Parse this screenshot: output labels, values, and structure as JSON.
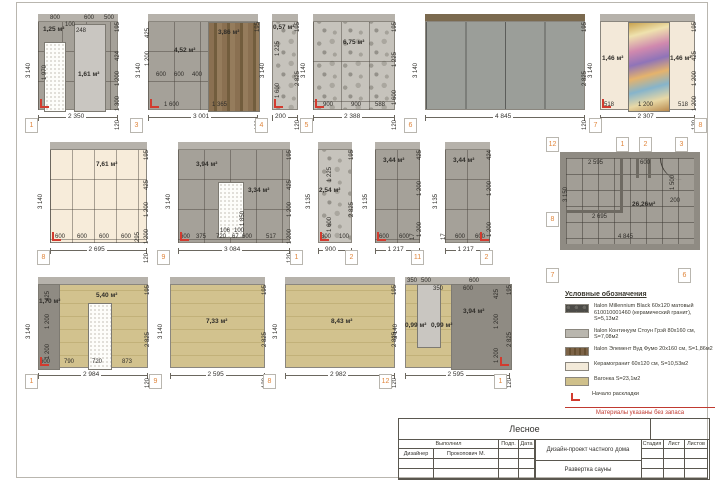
{
  "sheet": {
    "title_object": "Лесное"
  },
  "elevations": [
    {
      "id": "1",
      "x": 38,
      "y": 14,
      "w": 80,
      "h": 96,
      "fill": "gray",
      "band": "gray",
      "grid": [
        24,
        30
      ],
      "features": [
        {
          "t": "lightpanel",
          "x": 36,
          "y": 10,
          "w": 30,
          "h": 86
        },
        {
          "t": "door",
          "x": 6,
          "y": 28,
          "w": 20,
          "h": 68
        }
      ],
      "labels": [
        {
          "t": "1,25 м²",
          "x": 5,
          "y": 13,
          "a": 1
        },
        {
          "t": "1,61 м²",
          "x": 40,
          "y": 58,
          "a": 1
        },
        {
          "t": "1 970",
          "x": 10,
          "y": 60,
          "r": 1
        },
        {
          "t": "800",
          "x": 12,
          "y": 1
        },
        {
          "t": "100",
          "x": 27,
          "y": 8
        },
        {
          "t": "248",
          "x": 38,
          "y": 14
        },
        {
          "t": "600",
          "x": 46,
          "y": 1
        },
        {
          "t": "500",
          "x": 66,
          "y": 1
        }
      ],
      "bt": "2 350",
      "ld": "3 140",
      "rt": "195",
      "rd": [
        "424",
        "1 200",
        "1 300"
      ],
      "rdb": "120",
      "sm": "bl"
    },
    {
      "id": "3",
      "x": 148,
      "y": 14,
      "w": 110,
      "h": 96,
      "fill": "gray",
      "band": "gray",
      "grid": [
        26,
        30
      ],
      "features": [
        {
          "t": "wood",
          "x": 60,
          "y": 8,
          "w": 50,
          "h": 88
        }
      ],
      "labels": [
        {
          "t": "4,52 м²",
          "x": 26,
          "y": 34,
          "a": 1
        },
        {
          "t": "3,86 м²",
          "x": 70,
          "y": 16,
          "a": 1
        },
        {
          "t": "425",
          "x": 3,
          "y": 18,
          "r": 1
        },
        {
          "t": "1 200",
          "x": 3,
          "y": 46,
          "r": 1
        },
        {
          "t": "600",
          "x": 8,
          "y": 58
        },
        {
          "t": "600",
          "x": 26,
          "y": 58
        },
        {
          "t": "400",
          "x": 44,
          "y": 58
        },
        {
          "t": "1 600",
          "x": 16,
          "y": 88
        },
        {
          "t": "1 365",
          "x": 64,
          "y": 88
        }
      ],
      "bt": "3 001",
      "ld": "3 140",
      "rt": "195",
      "rd": [],
      "rdb": "120",
      "sm": "bl"
    },
    {
      "id": "4",
      "x": 272,
      "y": 14,
      "w": 26,
      "h": 96,
      "fill": "stone",
      "band": "gray",
      "grid": null,
      "features": [],
      "labels": [
        {
          "t": "0,57 м²",
          "x": 1,
          "y": 11,
          "a": 1
        },
        {
          "t": "1 225",
          "x": 9,
          "y": 36,
          "r": 1
        },
        {
          "t": "1 600",
          "x": 9,
          "y": 78,
          "r": 1
        }
      ],
      "bt": "200",
      "ld": "3 140",
      "rt": "195",
      "rd": [
        "2 825"
      ],
      "rdb": "120",
      "sm": "bl"
    },
    {
      "id": "5",
      "x": 313,
      "y": 14,
      "w": 82,
      "h": 96,
      "fill": "stone",
      "band": "gray",
      "grid": [
        28,
        40
      ],
      "features": [],
      "labels": [
        {
          "t": "6,75 м²",
          "x": 30,
          "y": 26,
          "a": 1
        },
        {
          "t": "900",
          "x": 10,
          "y": 88
        },
        {
          "t": "900",
          "x": 38,
          "y": 88
        },
        {
          "t": "588",
          "x": 62,
          "y": 88
        }
      ],
      "bt": "2 388",
      "ld": "3 140",
      "rt": "195",
      "rd": [
        "1 225",
        "1 600"
      ],
      "rdb": "120",
      "sm": "bl"
    },
    {
      "id": "6",
      "x": 425,
      "y": 14,
      "w": 160,
      "h": 96,
      "fill": "glass",
      "band": "wood",
      "grid": null,
      "features": [],
      "labels": [],
      "bt": "4 845",
      "ld": "3 140",
      "rt": "195",
      "rd": [
        "2 825"
      ],
      "rdb": "120",
      "sm": null
    },
    {
      "id": "7",
      "x": 600,
      "y": 14,
      "w": 95,
      "h": 96,
      "fill": "beige",
      "band": "gray",
      "grid": null,
      "features": [
        {
          "t": "mural",
          "x": 28,
          "y": 8,
          "w": 40,
          "h": 88
        }
      ],
      "labels": [
        {
          "t": "1,46 м²",
          "x": 2,
          "y": 42,
          "a": 1
        },
        {
          "t": "1,46 м²",
          "x": 70,
          "y": 42,
          "a": 1
        },
        {
          "t": "518",
          "x": 4,
          "y": 88
        },
        {
          "t": "1 200",
          "x": 38,
          "y": 88
        },
        {
          "t": "518",
          "x": 78,
          "y": 88
        }
      ],
      "bt": "2 307",
      "ld": "3 140",
      "rt": "195",
      "rd": [
        "425",
        "1 200",
        "1 200"
      ],
      "rdb": "120",
      "sm": "bl"
    },
    {
      "id": "8",
      "x": 50,
      "y": 142,
      "w": 97,
      "h": 101,
      "fill": "cream",
      "band": "gray",
      "grid": [
        22,
        30
      ],
      "features": [],
      "labels": [
        {
          "t": "7,61 м²",
          "x": 46,
          "y": 20,
          "a": 1
        },
        {
          "t": "600",
          "x": 5,
          "y": 92
        },
        {
          "t": "600",
          "x": 27,
          "y": 92
        },
        {
          "t": "600",
          "x": 49,
          "y": 92
        },
        {
          "t": "600",
          "x": 71,
          "y": 92
        },
        {
          "t": "295",
          "x": 91,
          "y": 94,
          "r": 1
        }
      ],
      "bt": "2 695",
      "ld": "3 140",
      "rt": "195",
      "rd": [
        "425",
        "1 200",
        "1 200"
      ],
      "rdb": "120",
      "sm": "bl"
    },
    {
      "id": "9",
      "x": 178,
      "y": 142,
      "w": 112,
      "h": 101,
      "fill": "gray",
      "band": "gray",
      "grid": [
        26,
        30
      ],
      "features": [
        {
          "t": "door",
          "x": 40,
          "y": 40,
          "w": 24,
          "h": 54
        }
      ],
      "labels": [
        {
          "t": "3,94 м²",
          "x": 18,
          "y": 20,
          "a": 1
        },
        {
          "t": "3,34 м²",
          "x": 70,
          "y": 46,
          "a": 1
        },
        {
          "t": "1 850",
          "x": 68,
          "y": 78,
          "r": 1
        },
        {
          "t": "106",
          "x": 42,
          "y": 86
        },
        {
          "t": "100",
          "x": 56,
          "y": 86
        },
        {
          "t": "600",
          "x": 2,
          "y": 92
        },
        {
          "t": "375",
          "x": 18,
          "y": 92
        },
        {
          "t": "720",
          "x": 38,
          "y": 92
        },
        {
          "t": "67",
          "x": 54,
          "y": 92
        },
        {
          "t": "600",
          "x": 64,
          "y": 92
        },
        {
          "t": "517",
          "x": 88,
          "y": 92
        }
      ],
      "bt": "3 084",
      "ld": "3 140",
      "rt": "195",
      "rd": [
        "425",
        "1 200",
        "1 200"
      ],
      "rdb": "120",
      "sm": "bl"
    },
    {
      "id": "10",
      "x": 318,
      "y": 142,
      "w": 34,
      "h": 101,
      "fill": "stone",
      "band": "gray",
      "grid": null,
      "features": [],
      "labels": [
        {
          "t": "2,54 м²",
          "x": 1,
          "y": 46,
          "a": 1
        },
        {
          "t": "1 225",
          "x": 15,
          "y": 34,
          "r": 1
        },
        {
          "t": "1 600",
          "x": 15,
          "y": 84,
          "r": 1
        },
        {
          "t": "800",
          "x": 3,
          "y": 92
        },
        {
          "t": "100",
          "x": 21,
          "y": 92
        }
      ],
      "bt": "900",
      "ld": "3 135",
      "rt": "195",
      "rd": [
        "2 825"
      ],
      "rdb": "120",
      "sm": "bl"
    },
    {
      "id": "11",
      "x": 375,
      "y": 142,
      "w": 45,
      "h": 101,
      "fill": "gray",
      "band": "gray",
      "grid": [
        22,
        30
      ],
      "features": [],
      "labels": [
        {
          "t": "3,44 м²",
          "x": 8,
          "y": 16,
          "a": 1
        },
        {
          "t": "600",
          "x": 4,
          "y": 92
        },
        {
          "t": "600",
          "x": 24,
          "y": 92
        },
        {
          "t": "17",
          "x": 41,
          "y": 92,
          "r": 1
        }
      ],
      "bt": "1 217",
      "ld": "3 135",
      "rt": "425",
      "rd": [
        "1 200",
        "1 200"
      ],
      "rdb": "120",
      "sm": "bl"
    },
    {
      "id": "12",
      "x": 445,
      "y": 142,
      "w": 45,
      "h": 101,
      "fill": "gray",
      "band": "gray",
      "grid": [
        22,
        30
      ],
      "features": [],
      "labels": [
        {
          "t": "3,44 м²",
          "x": 8,
          "y": 16,
          "a": 1
        },
        {
          "t": "17",
          "x": 2,
          "y": 92,
          "r": 1
        },
        {
          "t": "600",
          "x": 10,
          "y": 92
        },
        {
          "t": "600",
          "x": 30,
          "y": 92
        }
      ],
      "bt": "1 217",
      "ld": "3 135",
      "rt": "424",
      "rd": [
        "1 200",
        "1 200"
      ],
      "rdb": "120",
      "sm": "br"
    },
    {
      "id": "s1",
      "x": 38,
      "y": 277,
      "w": 110,
      "h": 91,
      "fill": "vagonka",
      "band": "gray",
      "grid": null,
      "features": [
        {
          "t": "graydark",
          "x": 0,
          "y": 7,
          "w": 20,
          "h": 84
        },
        {
          "t": "door",
          "x": 50,
          "y": 26,
          "w": 22,
          "h": 65
        }
      ],
      "labels": [
        {
          "t": "1,70 м²",
          "x": 1,
          "y": 22,
          "a": 1
        },
        {
          "t": "5,40 м²",
          "x": 58,
          "y": 16,
          "a": 1
        },
        {
          "t": "425",
          "x": 13,
          "y": 18,
          "r": 1
        },
        {
          "t": "1 200",
          "x": 13,
          "y": 46,
          "r": 1
        },
        {
          "t": "1 200",
          "x": 13,
          "y": 76,
          "r": 1
        },
        {
          "t": "600",
          "x": 2,
          "y": 82
        },
        {
          "t": "790",
          "x": 26,
          "y": 82
        },
        {
          "t": "720",
          "x": 54,
          "y": 82
        },
        {
          "t": "873",
          "x": 84,
          "y": 82
        }
      ],
      "bt": "2 984",
      "ld": "3 140",
      "rt": "195",
      "rd": [
        "2 825"
      ],
      "rdb": "120",
      "sm": "bl"
    },
    {
      "id": "s2",
      "x": 170,
      "y": 277,
      "w": 95,
      "h": 91,
      "fill": "vagonka",
      "band": "gray",
      "grid": null,
      "features": [],
      "labels": [
        {
          "t": "7,33 м²",
          "x": 36,
          "y": 42,
          "a": 1
        }
      ],
      "bt": "2 595",
      "ld": "3 140",
      "rt": "195",
      "rd": [
        "2 825"
      ],
      "rdb": "120",
      "sm": null
    },
    {
      "id": "s3",
      "x": 285,
      "y": 277,
      "w": 110,
      "h": 91,
      "fill": "vagonka",
      "band": "gray",
      "grid": null,
      "features": [],
      "labels": [
        {
          "t": "8,43 м²",
          "x": 46,
          "y": 42,
          "a": 1
        }
      ],
      "bt": "2 982",
      "ld": "3 140",
      "rt": "195",
      "rd": [
        "2 825"
      ],
      "rdb": "120",
      "sm": null
    },
    {
      "id": "s4",
      "x": 405,
      "y": 277,
      "w": 105,
      "h": 91,
      "fill": "vagonka",
      "band": "gray",
      "grid": null,
      "features": [
        {
          "t": "graydark",
          "x": 46,
          "y": 7,
          "w": 59,
          "h": 84
        },
        {
          "t": "lightpanel",
          "x": 12,
          "y": 7,
          "w": 22,
          "h": 62
        }
      ],
      "labels": [
        {
          "t": "350",
          "x": 2,
          "y": 1
        },
        {
          "t": "500",
          "x": 16,
          "y": 1
        },
        {
          "t": "600",
          "x": 64,
          "y": 1
        },
        {
          "t": "425",
          "x": 95,
          "y": 16,
          "r": 1
        },
        {
          "t": "350",
          "x": 28,
          "y": 9
        },
        {
          "t": "600",
          "x": 58,
          "y": 9
        },
        {
          "t": "3,94 м²",
          "x": 58,
          "y": 32,
          "a": 1
        },
        {
          "t": "0,99 м²",
          "x": 0,
          "y": 46,
          "a": 1
        },
        {
          "t": "0,99 м²",
          "x": 26,
          "y": 46,
          "a": 1
        },
        {
          "t": "1 200",
          "x": 95,
          "y": 46,
          "r": 1
        },
        {
          "t": "1 200",
          "x": 95,
          "y": 80,
          "r": 1
        }
      ],
      "bt": "2 595",
      "ld": "3 140",
      "rt": "195",
      "rd": [
        "2 825"
      ],
      "rdb": "120",
      "sm": "br"
    }
  ],
  "plan": {
    "x": 560,
    "y": 152,
    "w": 128,
    "h": 86,
    "area_label": "26,26м²",
    "labels": [
      {
        "t": "2 595",
        "x": 22,
        "y": 2
      },
      {
        "t": "600",
        "x": 74,
        "y": 2
      },
      {
        "t": "26,26м²",
        "x": 66,
        "y": 44,
        "a": 1
      },
      {
        "t": "2 695",
        "x": 26,
        "y": 56
      },
      {
        "t": "4 845",
        "x": 52,
        "y": 76
      },
      {
        "t": "200",
        "x": 104,
        "y": 40
      },
      {
        "t": "3 150",
        "x": 3,
        "y": 38,
        "r": 1
      },
      {
        "t": "1 500",
        "x": 110,
        "y": 26,
        "r": 1
      }
    ],
    "walls": [
      {
        "x": 54,
        "y": 0,
        "w": 3,
        "h": 52
      },
      {
        "x": 0,
        "y": 52,
        "w": 57,
        "h": 3
      },
      {
        "x": 70,
        "y": 0,
        "w": 3,
        "h": 20
      },
      {
        "x": 82,
        "y": 0,
        "w": 3,
        "h": 20
      }
    ]
  },
  "markers": [
    {
      "n": "1",
      "x": 25,
      "y": 118
    },
    {
      "n": "3",
      "x": 130,
      "y": 118
    },
    {
      "n": "4",
      "x": 255,
      "y": 118
    },
    {
      "n": "5",
      "x": 300,
      "y": 118
    },
    {
      "n": "6",
      "x": 404,
      "y": 118
    },
    {
      "n": "7",
      "x": 589,
      "y": 118
    },
    {
      "n": "8",
      "x": 694,
      "y": 118
    },
    {
      "n": "8",
      "x": 37,
      "y": 250
    },
    {
      "n": "9",
      "x": 157,
      "y": 250
    },
    {
      "n": "1",
      "x": 290,
      "y": 250
    },
    {
      "n": "2",
      "x": 345,
      "y": 250
    },
    {
      "n": "11",
      "x": 411,
      "y": 250
    },
    {
      "n": "2",
      "x": 480,
      "y": 250
    },
    {
      "n": "1",
      "x": 25,
      "y": 374
    },
    {
      "n": "9",
      "x": 149,
      "y": 374
    },
    {
      "n": "8",
      "x": 263,
      "y": 374
    },
    {
      "n": "12",
      "x": 379,
      "y": 374
    },
    {
      "n": "1",
      "x": 494,
      "y": 374
    },
    {
      "n": "12",
      "x": 546,
      "y": 137
    },
    {
      "n": "1",
      "x": 616,
      "y": 137
    },
    {
      "n": "2",
      "x": 639,
      "y": 137
    },
    {
      "n": "3",
      "x": 675,
      "y": 137
    },
    {
      "n": "8",
      "x": 546,
      "y": 212
    },
    {
      "n": "4",
      "x": 678,
      "y": 212
    },
    {
      "n": "9",
      "x": 622,
      "y": 212
    },
    {
      "n": "5",
      "x": 653,
      "y": 215
    },
    {
      "n": "10",
      "x": 631,
      "y": 182
    },
    {
      "n": "11",
      "x": 644,
      "y": 182
    },
    {
      "n": "7",
      "x": 546,
      "y": 268
    },
    {
      "n": "6",
      "x": 678,
      "y": 268
    }
  ],
  "legend": {
    "title": "Условные обозначения",
    "items": [
      {
        "swatch": "millennium",
        "text": "Italon Millennium Black 60х120 матовый 610010001460 (керамический гранит), S=5,13м2"
      },
      {
        "swatch": "continuum",
        "text": "Italon Континуум Стоун Грэй 80х160 см, S=7,08м2"
      },
      {
        "swatch": "element",
        "text": "Italon Элемент Вуд Фумо 20х160 см, S=1,86м2"
      },
      {
        "swatch": "keram",
        "text": "Керамогранит 60х120 см, S=10,53м2"
      },
      {
        "swatch": "vagonka",
        "text": "Вагонка S=23,1м2"
      },
      {
        "swatch": "start",
        "text": "Начало раскладки"
      }
    ],
    "note": "Материалы указаны без запаса"
  },
  "titleblock": {
    "object": "Лесное",
    "col_done": "Выполнил",
    "col_sign": "Подп.",
    "col_date": "Дата",
    "role": "Дизайнер",
    "person": "Прокопович М.",
    "project": "Дизайн-проект частного дома",
    "sheet": "Развертка сауны",
    "stage": "Стадия",
    "list": "Лист",
    "lists": "Листов"
  }
}
